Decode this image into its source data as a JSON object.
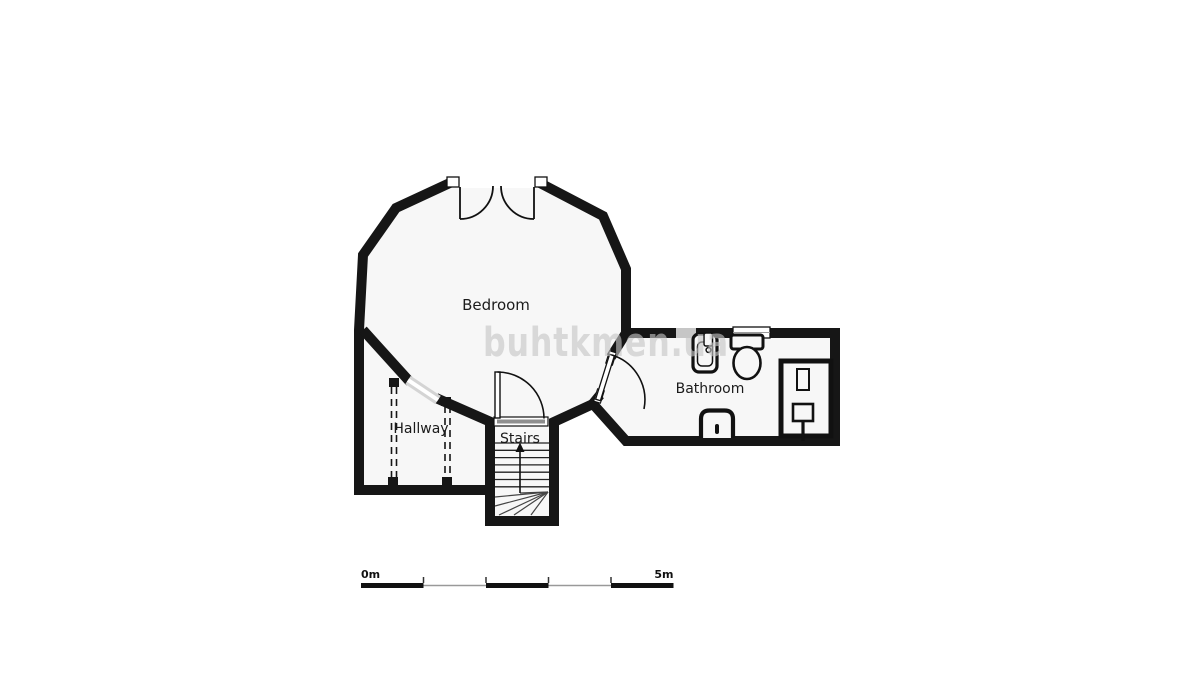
{
  "page": {
    "background": "#ffffff"
  },
  "floor_plan": {
    "rooms": [
      {
        "id": "bedroom",
        "label": "Bedroom"
      },
      {
        "id": "bathroom",
        "label": "Bathroom"
      },
      {
        "id": "hallway",
        "label": "Hallway"
      },
      {
        "id": "stairs",
        "label": "Stairs"
      }
    ],
    "fixtures": [
      {
        "name": "sink-icon",
        "room": "bathroom"
      },
      {
        "name": "toilet-icon",
        "room": "bathroom"
      },
      {
        "name": "shower-icon",
        "room": "bathroom"
      },
      {
        "name": "bidet-icon",
        "room": "bathroom"
      },
      {
        "name": "stairs-up-arrow-icon",
        "room": "stairs"
      }
    ],
    "doors": [
      {
        "name": "double-door",
        "location": "bedroom-top"
      },
      {
        "name": "door",
        "location": "bedroom-to-bathroom"
      },
      {
        "name": "door",
        "location": "stairs-to-bedroom"
      }
    ],
    "colors": {
      "wall": "#161616",
      "floor": "#f7f7f7",
      "background": "#ffffff",
      "window_gray": "#d4d4d4",
      "scale_gray": "#999999",
      "watermark": "#c6c6c6"
    }
  },
  "labels": {
    "bedroom": "Bedroom",
    "bathroom": "Bathroom",
    "hallway": "Hallway",
    "stairs": "Stairs"
  },
  "scale_bar": {
    "start": "0m",
    "end": "5m",
    "segments": 5,
    "total_meters": 5
  },
  "watermark": {
    "text": "buhtkmen.ua"
  }
}
